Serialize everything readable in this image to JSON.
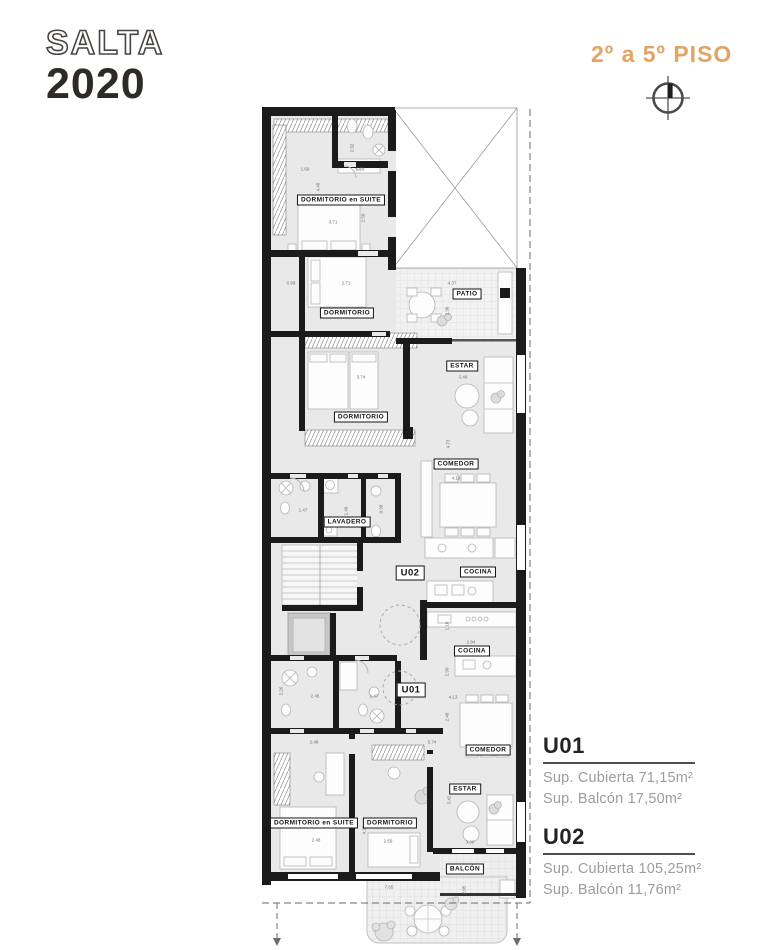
{
  "header": {
    "brand_line1": "SALTA",
    "brand_line2": "2020",
    "floor_range": "2º a 5º PISO"
  },
  "icons": {
    "compass": "circle-crosshair-north-indicator"
  },
  "colors": {
    "accent": "#E3A363",
    "wall": "#1b1b1b",
    "ink": "#2e2a28",
    "muted": "#9c9c9c"
  },
  "plan": {
    "rooms": [
      {
        "label": "DORMITORIO en SUITE"
      },
      {
        "label": "DORMITORIO"
      },
      {
        "label": "PATIO"
      },
      {
        "label": "DORMITORIO"
      },
      {
        "label": "ESTAR"
      },
      {
        "label": "COMEDOR"
      },
      {
        "label": "LAVADERO"
      },
      {
        "label": "U02"
      },
      {
        "label": "COCINA"
      },
      {
        "label": "COCINA"
      },
      {
        "label": "U01"
      },
      {
        "label": "COMEDOR"
      },
      {
        "label": "DORMITORIO en SUITE"
      },
      {
        "label": "DORMITORIO"
      },
      {
        "label": "ESTAR"
      },
      {
        "label": "BALCÓN"
      }
    ],
    "dimensions": [
      {
        "t": "1.69"
      },
      {
        "t": "1.59"
      },
      {
        "t": "2.02"
      },
      {
        "t": "4.48"
      },
      {
        "t": "3.71"
      },
      {
        "t": "2.50"
      },
      {
        "t": "0.99"
      },
      {
        "t": "2.71"
      },
      {
        "t": "4.37"
      },
      {
        "t": "2.30"
      },
      {
        "t": "3.74"
      },
      {
        "t": "3.48"
      },
      {
        "t": "4.73"
      },
      {
        "t": "4.19"
      },
      {
        "t": "1.47"
      },
      {
        "t": "1.40"
      },
      {
        "t": "0.98"
      },
      {
        "t": "2.94"
      },
      {
        "t": "1.10"
      },
      {
        "t": "2.90"
      },
      {
        "t": "4.13"
      },
      {
        "t": "2.48"
      },
      {
        "t": "2.45"
      },
      {
        "t": "1.47"
      },
      {
        "t": "2.26"
      },
      {
        "t": "2.48"
      },
      {
        "t": "5.74"
      },
      {
        "t": "2.48"
      },
      {
        "t": "2.59"
      },
      {
        "t": "4.25"
      },
      {
        "t": "3.42"
      },
      {
        "t": "3.06"
      },
      {
        "t": "7.65"
      },
      {
        "t": "2.05"
      }
    ]
  },
  "legend": {
    "units": [
      {
        "id": "U01",
        "lines": [
          "Sup. Cubierta 71,15m²",
          "Sup. Balcón 17,50m²"
        ]
      },
      {
        "id": "U02",
        "lines": [
          "Sup. Cubierta 105,25m²",
          "Sup. Balcón 11,76m²"
        ]
      }
    ]
  }
}
